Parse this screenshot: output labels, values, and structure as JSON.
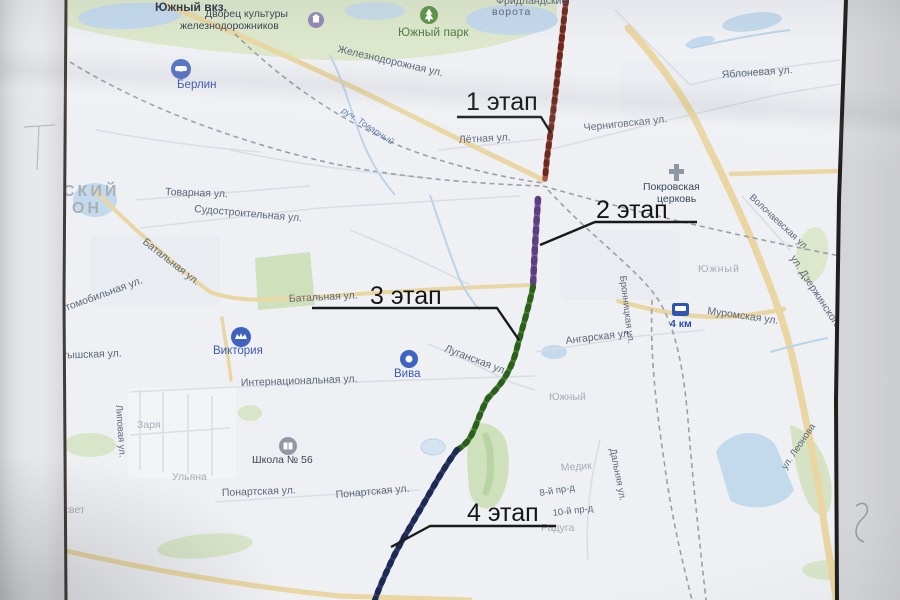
{
  "title": "Фотография схемы этапов (карта города)",
  "stages": [
    {
      "label": "1 этап",
      "color": "#9d4b3c"
    },
    {
      "label": "2 этап",
      "color": "#7d5ba0"
    },
    {
      "label": "3 этап",
      "color": "#3f7d2c"
    },
    {
      "label": "4 этап",
      "color": "#2c3c6e"
    }
  ],
  "colors": {
    "paper": "#eef0f4",
    "water": "#c3d9ec",
    "park": "#dce7cb",
    "major_road": "#e9d6a2",
    "stage1": "#9d4b3c",
    "stage2": "#7d5ba0",
    "stage3": "#3f7d2c",
    "stage4": "#2c3c6e"
  },
  "texts": {
    "yuzhny_vkz": "Южный вкз.",
    "dk1": "Дворец культуры",
    "dk2": "железнодорожников",
    "yuzhny_park": "Южный парк",
    "vorota1": "Фридландские",
    "vorota2": "ворота",
    "zheldor_ul": "Железнодорожная ул.",
    "ruch_tovarny": "руч. Товарный",
    "berlin": "Берлин",
    "yablonevaya": "Яблоневая ул.",
    "chernigovskaya": "Черниговская ул.",
    "letnaya": "Лётная ул.",
    "msk1": "СКИЙ",
    "msk2": "ОН",
    "tovarnaya": "Товарная ул.",
    "sudostroitelnaya": "Судостроительная ул.",
    "pokrovskaya1": "Покровская",
    "pokrovskaya2": "церковь",
    "volochaevskaya": "Волочаевская ул.",
    "dzerzhinskogo": "ул. Дзержинского",
    "batalnaya1": "Батальная ул.",
    "avtomobilnaya": "Автомобильная ул.",
    "batalnaya2": "Батальная ул.",
    "bronnitskaya": "Бронницкая ул.",
    "angarskaya": "Ангарская ул.",
    "yuzhny1": "Южный",
    "km4": "4 км",
    "muromskaya": "Муромская ул.",
    "latyshskaya": "Латышская ул.",
    "viktoriya": "Виктория",
    "viva": "Вива",
    "luganskaya": "Луганская ул.",
    "internatsionalnaya": "Интернациональная ул.",
    "yuzhny2": "Южный",
    "zarya": "Заря",
    "lipovaya": "Липовая ул.",
    "shkola56": "Школа № 56",
    "ulyana": "Ульяна",
    "rassvet": "Рассвет",
    "ponartskaya1": "Понартская ул.",
    "ponartskaya2": "Понартская ул.",
    "medik": "Медик",
    "prd8": "8-й пр-д",
    "prd10": "10-й пр-д",
    "raduga": "Радуга",
    "dalnyaya": "Дальняя ул.",
    "leonova": "ул. Леонова"
  }
}
